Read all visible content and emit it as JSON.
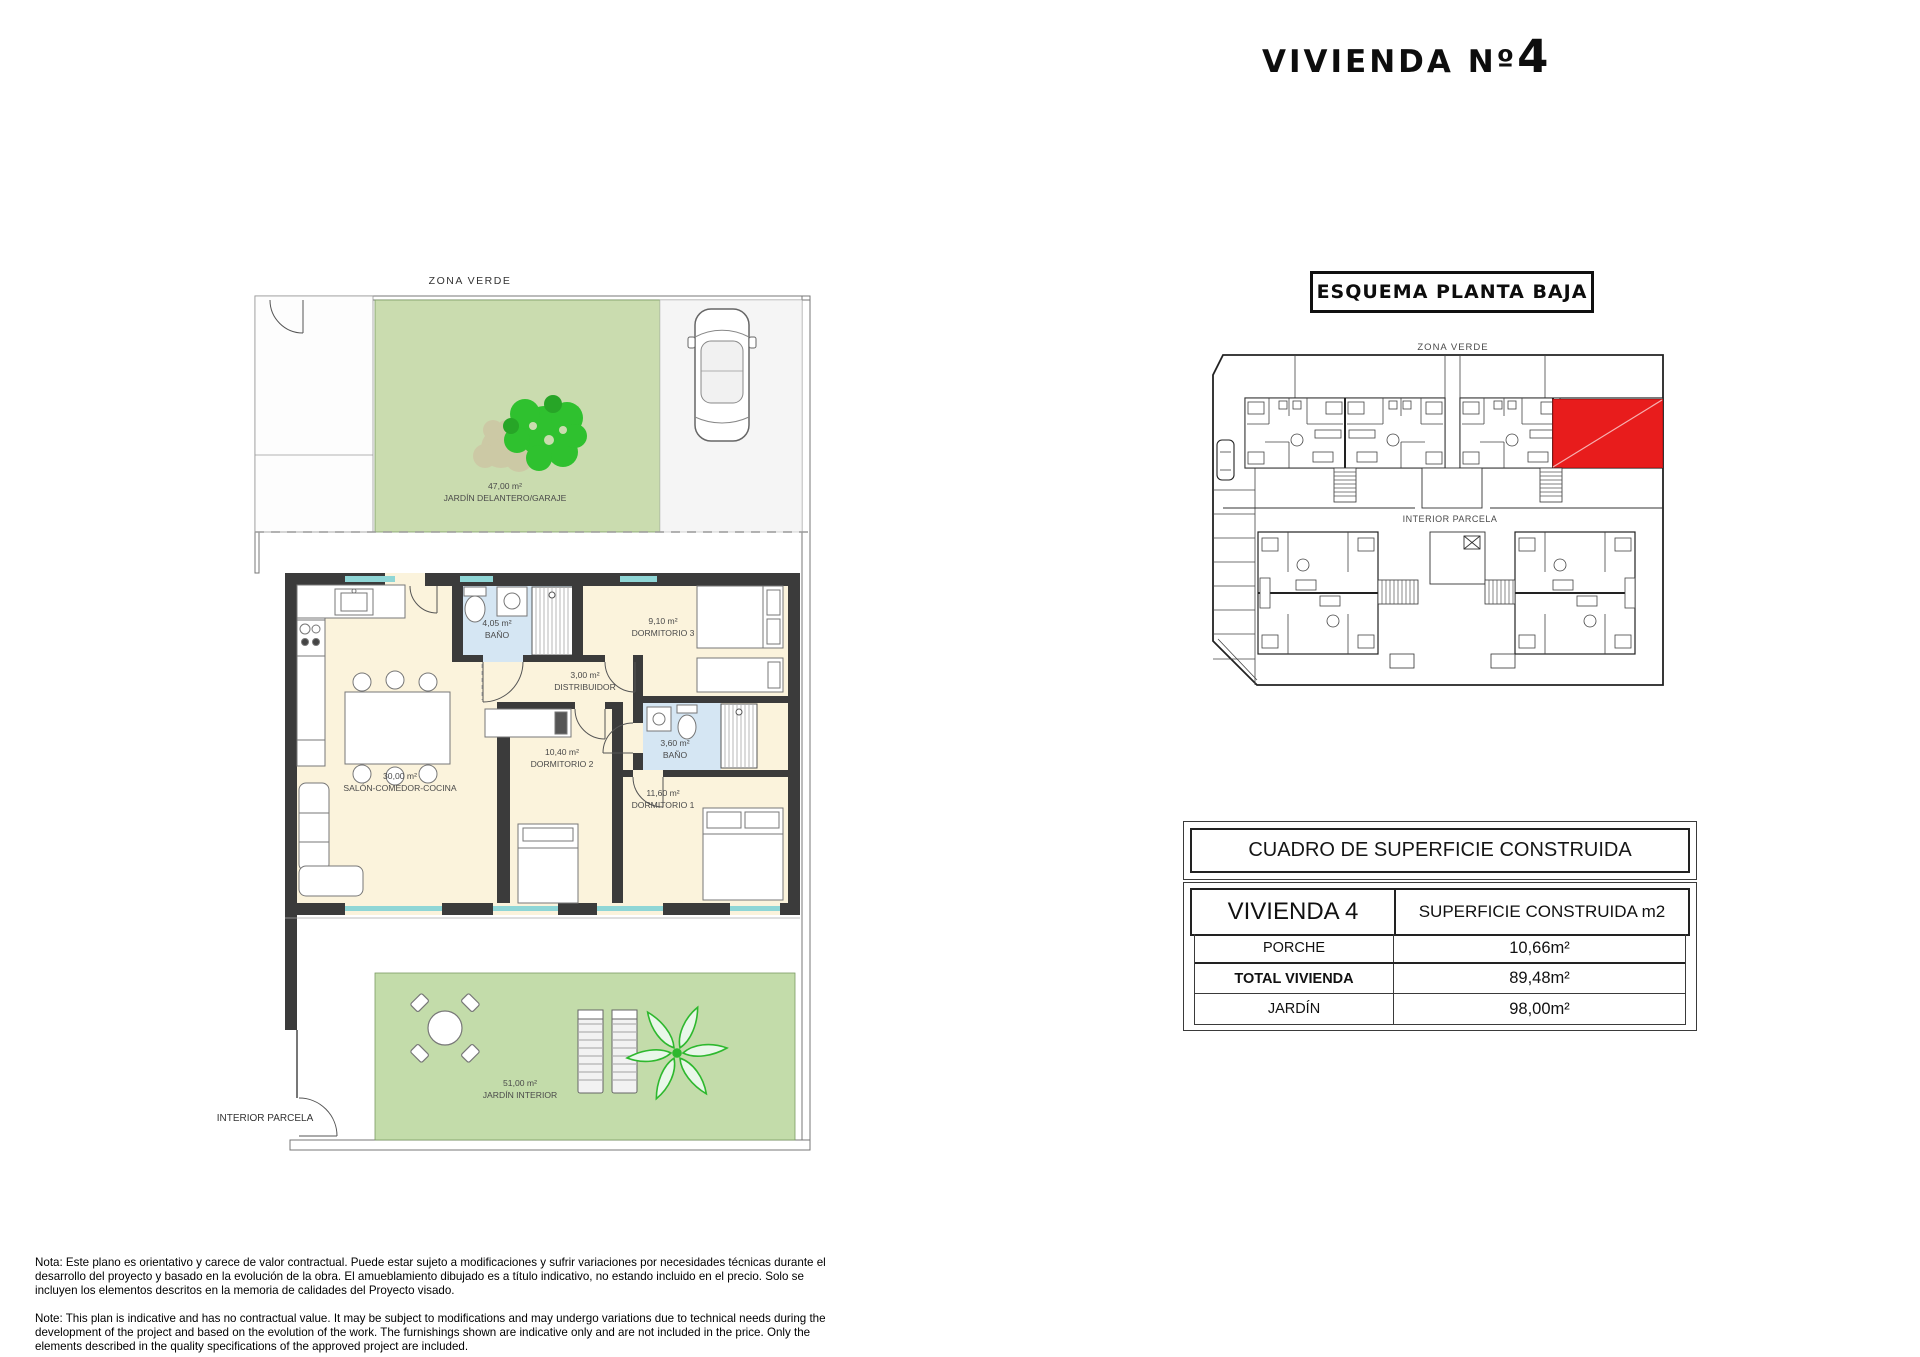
{
  "title": {
    "prefix": "VIVIENDA Nº",
    "number": "4"
  },
  "main_plan": {
    "zone_top_label": "ZONA VERDE",
    "front_garden": {
      "area": "47,00 m²",
      "label": "JARDÍN DELANTERO/GARAJE"
    },
    "rooms": [
      {
        "area": "30,00 m²",
        "label": "SALÓN-COMEDOR-COCINA"
      },
      {
        "area": "4,05 m²",
        "label": "BAÑO"
      },
      {
        "area": "9,10 m²",
        "label": "DORMITORIO 3"
      },
      {
        "area": "3,00 m²",
        "label": "DISTRIBUIDOR"
      },
      {
        "area": "10,40 m²",
        "label": "DORMITORIO 2"
      },
      {
        "area": "3,60 m²",
        "label": "BAÑO"
      },
      {
        "area": "11,60 m²",
        "label": "DORMITORIO 1"
      }
    ],
    "interior_garden": {
      "area": "51,00 m²",
      "label": "JARDÍN INTERIOR"
    },
    "bottom_left_label": "INTERIOR PARCELA"
  },
  "schema_panel": {
    "title": "ESQUEMA PLANTA BAJA",
    "zone_top_label": "ZONA VERDE",
    "center_label": "INTERIOR PARCELA"
  },
  "surface_table": {
    "title": "CUADRO DE SUPERFICIE CONSTRUIDA",
    "col1_header": "VIVIENDA 4",
    "col2_header": "SUPERFICIE CONSTRUIDA m2",
    "rows": [
      {
        "label": "PORCHE",
        "value": "10,66m²"
      },
      {
        "label": "TOTAL  VIVIENDA",
        "value": "89,48m²"
      },
      {
        "label": "JARDÍN",
        "value": "98,00m²"
      }
    ]
  },
  "notes": {
    "spanish": "Nota: Este plano es orientativo y carece de valor contractual. Puede estar sujeto a modificaciones y sufrir variaciones por necesidades técnicas durante el desarrollo del proyecto y basado en la evolución de la obra. El amueblamiento dibujado es a título indicativo, no estando incluido en el precio. Solo se incluyen los elementos descritos en la memoria de calidades del Proyecto visado.",
    "english": "Note: This plan is indicative and has no contractual value. It may be subject to modifications and may undergo variations due to technical needs during the development of the project and based on the evolution of the work. The furnishings shown are indicative only and are not included in the price. Only the elements described in the quality specifications of the approved project are included."
  },
  "colors": {
    "highlight_red": "#e81c1c",
    "garden_green": "#cadcaf",
    "room_cream": "#fbf3dc",
    "bath_blue": "#d5e6f3",
    "wall_dark": "#3b3b3b",
    "glass_teal": "#8fd6d6",
    "tree_green": "#2fc12f"
  }
}
